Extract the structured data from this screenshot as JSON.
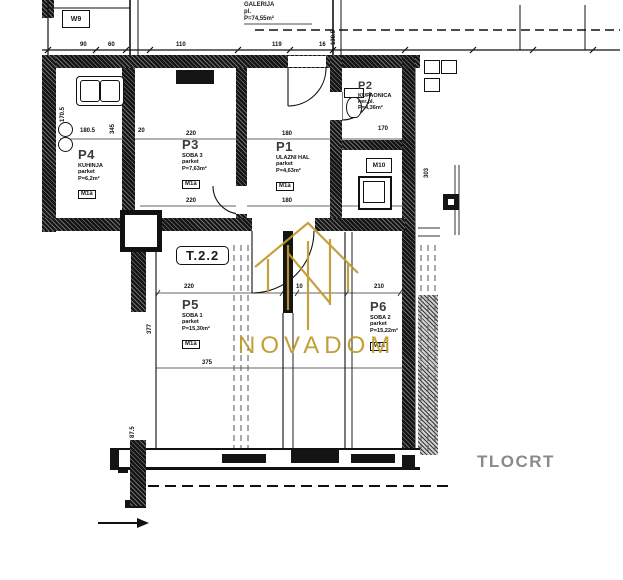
{
  "watermark": {
    "brand": "NOVADOM",
    "color": "#bf9a2e"
  },
  "plan": {
    "title": "TLOCRT",
    "unit_code": "T.2.2",
    "galerija": {
      "name": "GALERIJA",
      "floor": "pl.",
      "area": "P=74,55m²"
    },
    "rooms": {
      "p1": {
        "id": "P1",
        "name": "ULAZNI HAL",
        "floor": "parket",
        "area": "P=4,63m²",
        "tag": "M1a"
      },
      "p2": {
        "id": "P2",
        "name": "KUPAONICA",
        "floor": "ker.pl.",
        "area": "P=4,36m²"
      },
      "p3": {
        "id": "P3",
        "name": "SOBA 3",
        "floor": "parket",
        "area": "P=7,63m²",
        "tag": "M1a"
      },
      "p4": {
        "id": "P4",
        "name": "KUHINJA",
        "floor": "parket",
        "area": "P=6,2m²",
        "tag": "M1a"
      },
      "p5": {
        "id": "P5",
        "name": "SOBA 1",
        "floor": "parket",
        "area": "P=15,30m²",
        "tag": "M1a"
      },
      "p6": {
        "id": "P6",
        "name": "SOBA 2",
        "floor": "parket",
        "area": "P=15,22m²",
        "tag": "M1a"
      }
    },
    "labels": {
      "w9": "W9",
      "m10": "M10"
    },
    "dims": {
      "t90": "90",
      "t60": "60",
      "t110": "110",
      "t119": "119",
      "t16": "16",
      "v1385": "138.5",
      "v1705": "170.5",
      "h1805": "180.5",
      "v345": "345",
      "h20": "20",
      "p3a": "220",
      "p3b": "220",
      "p1a": "180",
      "p1b": "180",
      "p2a": "170",
      "p5a": "220",
      "p6a": "210",
      "m22": "22",
      "c10": "10",
      "v377": "377",
      "b375": "375",
      "v303": "303",
      "v875": "87.5"
    }
  }
}
